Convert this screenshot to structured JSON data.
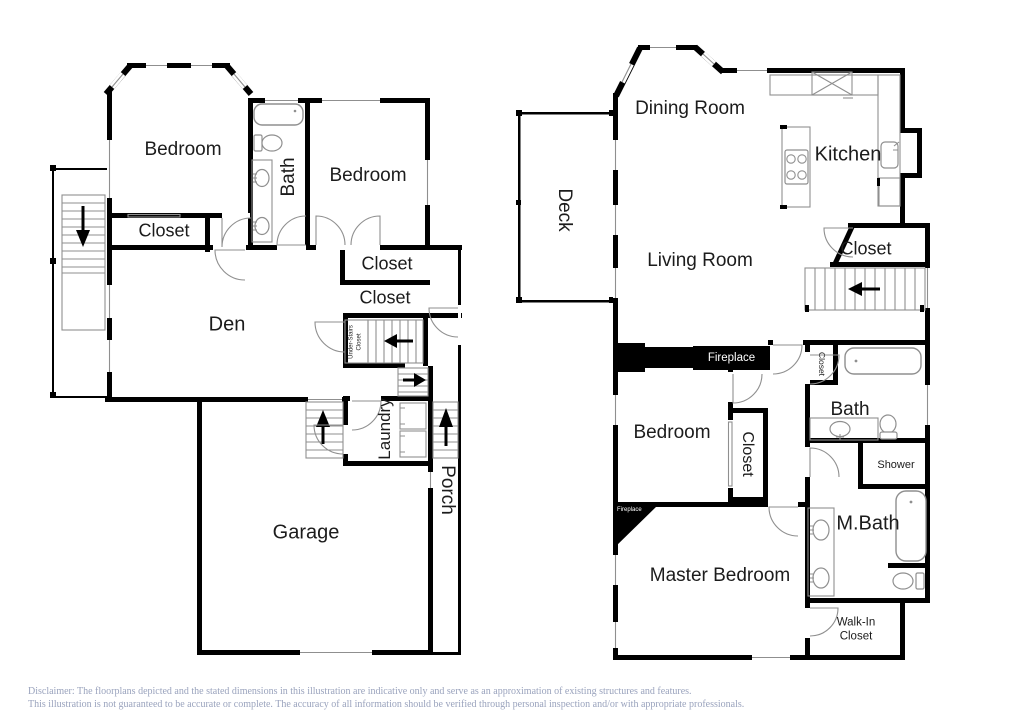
{
  "colors": {
    "background": "#ffffff",
    "wall": "#000000",
    "fixture_line": "#8f8f8f",
    "room_text": "#1c1c1c",
    "fireplace_text": "#ffffff",
    "disclaimer_text": "#9aa3bd"
  },
  "first_floor": {
    "bedroom_top_left_label": "Bedroom",
    "bath_label": "Bath",
    "bedroom_top_right_label": "Bedroom",
    "bedroom_closet_label": "Closet",
    "den_label": "Den",
    "hall_closet_upper_label": "Closet",
    "hall_closet_lower_label": "Closet",
    "under_stairs_closet_line1": "Under-Stairs",
    "under_stairs_closet_line2": "Closet",
    "laundry_label": "Laundry",
    "garage_label": "Garage",
    "porch_label": "Porch"
  },
  "second_floor": {
    "dining_room_label": "Dining Room",
    "kitchen_label": "Kitchen",
    "deck_label": "Deck",
    "living_room_label": "Living Room",
    "stair_closet_label": "Closet",
    "living_fireplace_label": "Fireplace",
    "bedroom_label": "Bedroom",
    "bedroom_closet_label": "Closet",
    "bath_closet_label": "Closet",
    "bath_label": "Bath",
    "shower_label": "Shower",
    "master_bath_label": "M.Bath",
    "master_fireplace_label": "Fireplace",
    "master_bedroom_label": "Master Bedroom",
    "walk_in_closet_line1": "Walk-In",
    "walk_in_closet_line2": "Closet"
  },
  "footer": {
    "disclaimer_line1": "Disclaimer: The floorplans depicted and the stated dimensions in this illustration are indicative only and serve as an approximation of existing structures and features.",
    "disclaimer_line2": "This illustration is not guaranteed to be accurate or complete. The accuracy of all information should be verified through personal inspection and/or with appropriate professionals."
  }
}
